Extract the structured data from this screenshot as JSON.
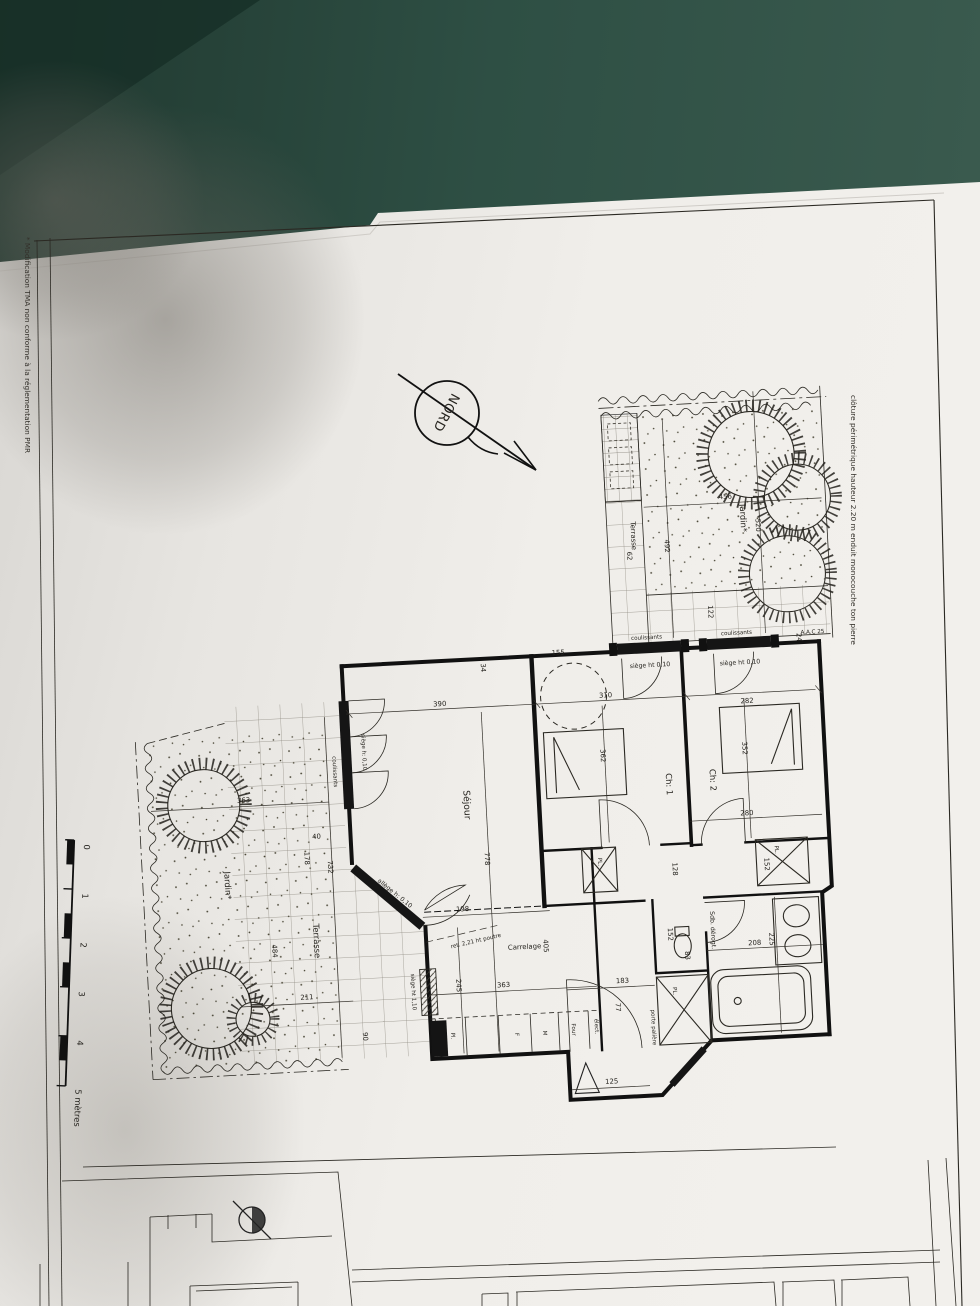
{
  "plan": {
    "compass": "NORD",
    "notes": {
      "margin": "* Modification TMA non conforme à la réglementation PMR",
      "fence": "clôture périmétrique hauteur 2.20 m enduit monocouche ton pierre"
    },
    "rooms": {
      "sejour": "Séjour",
      "ch1": "Ch: 1",
      "ch2": "Ch: 2",
      "jardin": "Jardin*",
      "terrasse": "Terrasse",
      "carrelage": "Carrelage",
      "sdb": "Sdb. dérogt."
    },
    "fixtures": {
      "porte_paliere": "porte palière",
      "elec": "élect.",
      "pl": "Pl.",
      "frigo": "F",
      "m": "M",
      "four": "Four",
      "placard": "PL.",
      "aac": "A.A.C 25"
    },
    "windows": {
      "coulissants": "coulissants",
      "siege010": "siège ht 0,10",
      "siegeh010": "siège h: 0,10",
      "allege010": "allège h: 0,10",
      "siege110": "siège ht 1,10"
    },
    "annotations": {
      "poutre": "ret. 2,21 ht poutre"
    },
    "dims": {
      "d24": "24",
      "d34": "34",
      "d40": "40",
      "d62": "62",
      "d77": "77",
      "d83": "83",
      "d90": "90",
      "d122": "122",
      "d125": "125",
      "d128": "128",
      "d152": "152",
      "d155": "155",
      "d178": "178",
      "d183": "183",
      "d198": "198",
      "d208": "208",
      "d211": "211",
      "d225": "225",
      "d245": "245",
      "d280": "280",
      "d282": "282",
      "d310": "310",
      "d352": "352",
      "d362": "362",
      "d363": "363",
      "d390": "390",
      "d405": "405",
      "d456": "456",
      "d484": "484",
      "d492": "492",
      "d520": "520",
      "d732": "732",
      "d778": "778"
    },
    "scale": {
      "t0": "0",
      "t1": "1",
      "t2": "2",
      "t3": "3",
      "t4": "4",
      "t5": "5 mètres"
    },
    "colors": {
      "background": "#2e4b42",
      "paper": "#edebe7",
      "ink": "#1c1c1c"
    }
  }
}
